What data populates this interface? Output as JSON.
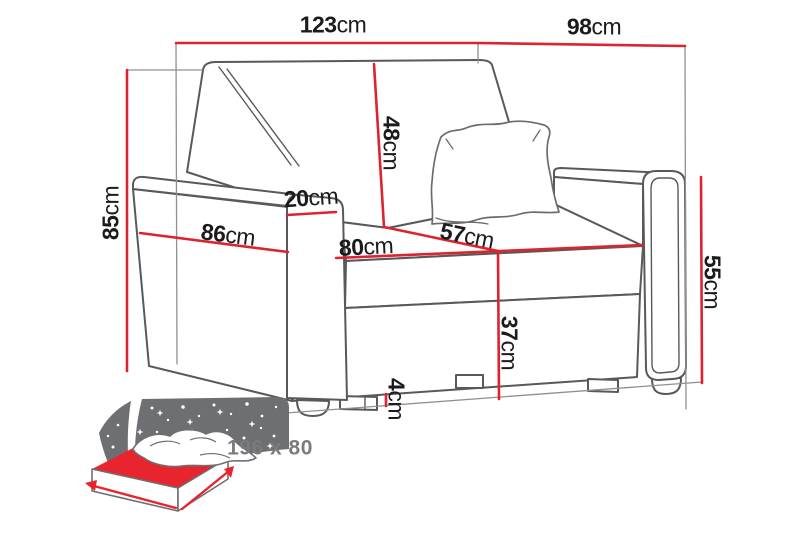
{
  "colors": {
    "dimension_line_red": "#dc2430",
    "sofa_outline_gray": "#58595b",
    "label_text_black": "#1b1b1d",
    "icon_gray": "#6e6f72",
    "sleep_text_gray": "#7a7b7e"
  },
  "dimensions": {
    "total_width": {
      "value": "123",
      "unit": "cm"
    },
    "total_depth": {
      "value": "98",
      "unit": "cm"
    },
    "total_height": {
      "value": "85",
      "unit": "cm"
    },
    "backrest_height": {
      "value": "48",
      "unit": "cm"
    },
    "armrest_width": {
      "value": "20",
      "unit": "cm"
    },
    "side_length": {
      "value": "86",
      "unit": "cm"
    },
    "seat_width": {
      "value": "80",
      "unit": "cm"
    },
    "seat_depth": {
      "value": "57",
      "unit": "cm"
    },
    "seat_height": {
      "value": "37",
      "unit": "cm"
    },
    "armrest_height": {
      "value": "55",
      "unit": "cm"
    },
    "leg_height": {
      "value": "4",
      "unit": "cm"
    }
  },
  "sleeping_function": {
    "icon": "sleeping-bed-icon",
    "size_label": "196 x 80"
  }
}
